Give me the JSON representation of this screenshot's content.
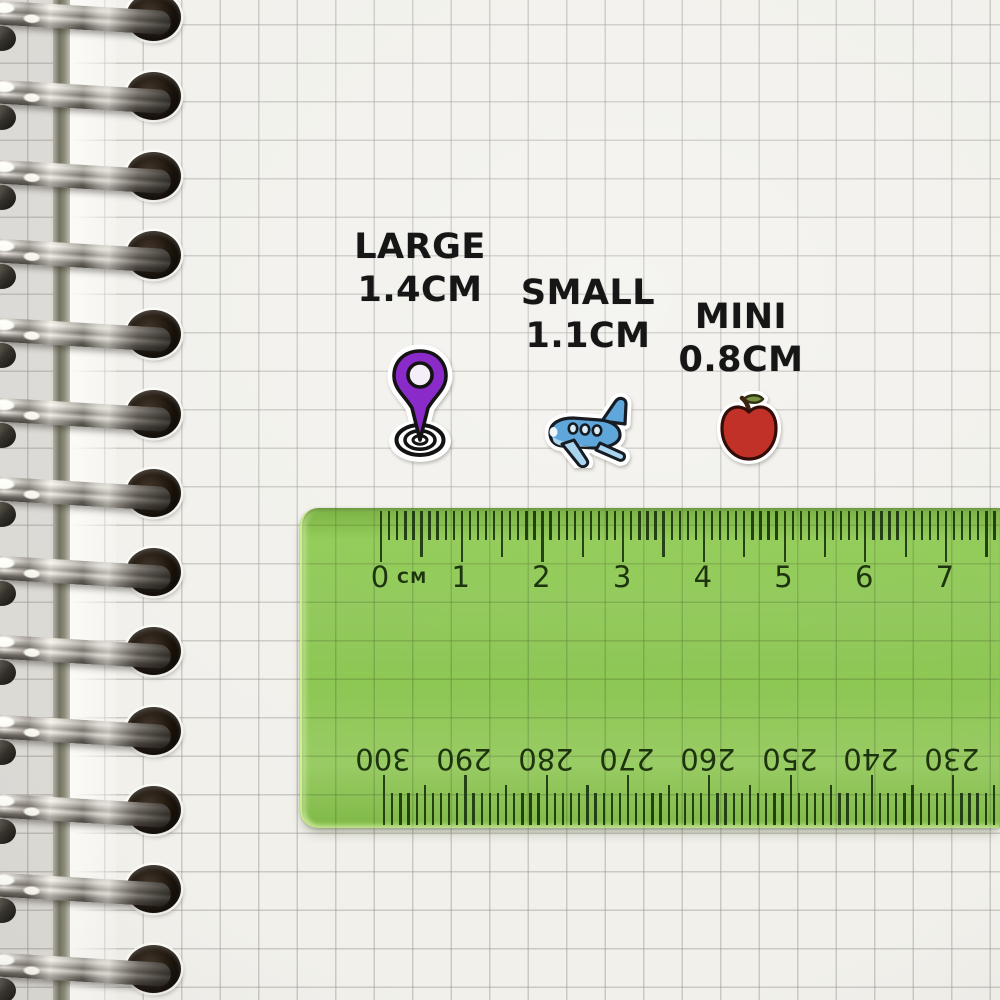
{
  "stickers": [
    {
      "id": "location-pin",
      "label": "LARGE",
      "size": "1.4CM",
      "color": "#8a2bc9"
    },
    {
      "id": "airplane",
      "label": "SMALL",
      "size": "1.1CM",
      "color": "#5fa6db"
    },
    {
      "id": "apple",
      "label": "MINI",
      "size": "0.8CM",
      "color": "#c23128"
    }
  ],
  "ruler": {
    "unit_label": "CM",
    "top_scale_numbers": [
      "0",
      "1",
      "2",
      "3",
      "4",
      "5",
      "6",
      "7"
    ],
    "bottom_scale_numbers": [
      "300",
      "290",
      "280",
      "270",
      "260",
      "250",
      "240",
      "230"
    ],
    "body_color": "#96d35c",
    "marking_color": "#1d340f"
  },
  "colors": {
    "paper": "#f1f0eb",
    "grid_line": "#c6c5c1",
    "label_text": "#161616",
    "binding_metal": "#d8d5ce"
  }
}
